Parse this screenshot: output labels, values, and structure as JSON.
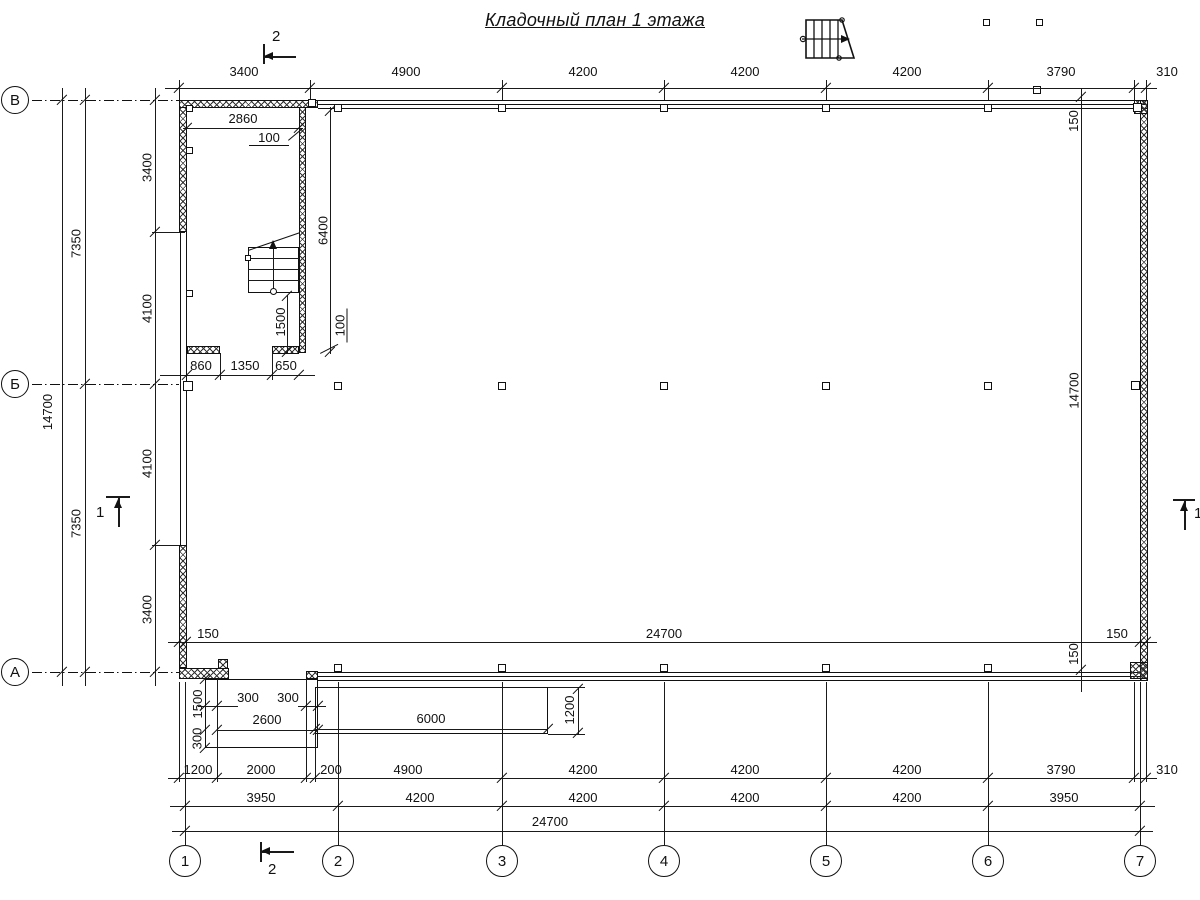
{
  "title": "Кладочный план 1 этажа",
  "axis_rows": [
    "В",
    "Б",
    "А"
  ],
  "axis_cols": [
    "1",
    "2",
    "3",
    "4",
    "5",
    "6",
    "7"
  ],
  "marks": {
    "top": "2",
    "bottom": "2",
    "left": "1",
    "right": "1"
  },
  "top_dims": [
    "3400",
    "4900",
    "4200",
    "4200",
    "4200",
    "3790",
    "310"
  ],
  "row1": [
    "1200",
    "2000",
    "200",
    "4900",
    "4200",
    "4200",
    "4200",
    "3790",
    "310"
  ],
  "row2": [
    "3950",
    "4200",
    "4200",
    "4200",
    "4200",
    "3950"
  ],
  "row3": [
    "24700"
  ],
  "left_inner": [
    "3400",
    "4100",
    "4100",
    "3400"
  ],
  "left_mid": [
    "7350",
    "7350"
  ],
  "left_outer": [
    "14700"
  ],
  "band": [
    "150",
    "24700",
    "150"
  ],
  "right_chain": [
    "150",
    "14700",
    "150"
  ],
  "stair": {
    "width": "2860",
    "wall_top": "100",
    "depth": "6400",
    "run": "1500",
    "wall_bottom": "100",
    "bottom": [
      "860",
      "1350",
      "650"
    ]
  },
  "porch": {
    "left": "300",
    "right": "300",
    "width": "2600",
    "depth": "1500",
    "step": "300"
  },
  "ramp": {
    "length": "6000",
    "depth": "1200"
  }
}
